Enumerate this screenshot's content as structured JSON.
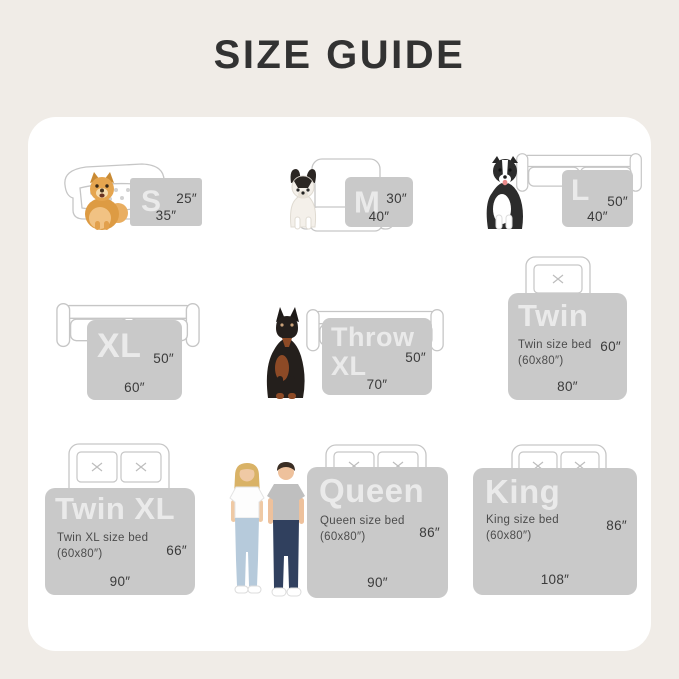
{
  "title": "SIZE GUIDE",
  "palette": {
    "page_bg": "#f0ece7",
    "card_bg": "#ffffff",
    "panel_gray": "#c9c9c9",
    "title_color": "#323232",
    "dim_text": "#3b3b3b",
    "outline": "#c6c6c6"
  },
  "sizes": [
    {
      "id": "s",
      "label": "S",
      "height": "25″",
      "width": "35″"
    },
    {
      "id": "m",
      "label": "M",
      "height": "30″",
      "width": "40″"
    },
    {
      "id": "l",
      "label": "L",
      "height": "50″",
      "width": "40″"
    },
    {
      "id": "xl",
      "label": "XL",
      "height": "50″",
      "width": "60″"
    },
    {
      "id": "throw-xl",
      "label": "Throw XL",
      "height": "50″",
      "width": "70″"
    },
    {
      "id": "twin",
      "label": "Twin",
      "bed_line1": "Twin size bed",
      "bed_line2": "(60x80″)",
      "height": "60″",
      "width": "80″"
    },
    {
      "id": "twin-xl",
      "label": "Twin XL",
      "bed_line1": "Twin XL size bed",
      "bed_line2": "(60x80″)",
      "height": "66″",
      "width": "90″"
    },
    {
      "id": "queen",
      "label": "Queen",
      "bed_line1": "Queen size bed",
      "bed_line2": "(60x80″)",
      "height": "86″",
      "width": "90″"
    },
    {
      "id": "king",
      "label": "King",
      "bed_line1": "King size bed",
      "bed_line2": "(60x80″)",
      "height": "86″",
      "width": "108″"
    }
  ]
}
